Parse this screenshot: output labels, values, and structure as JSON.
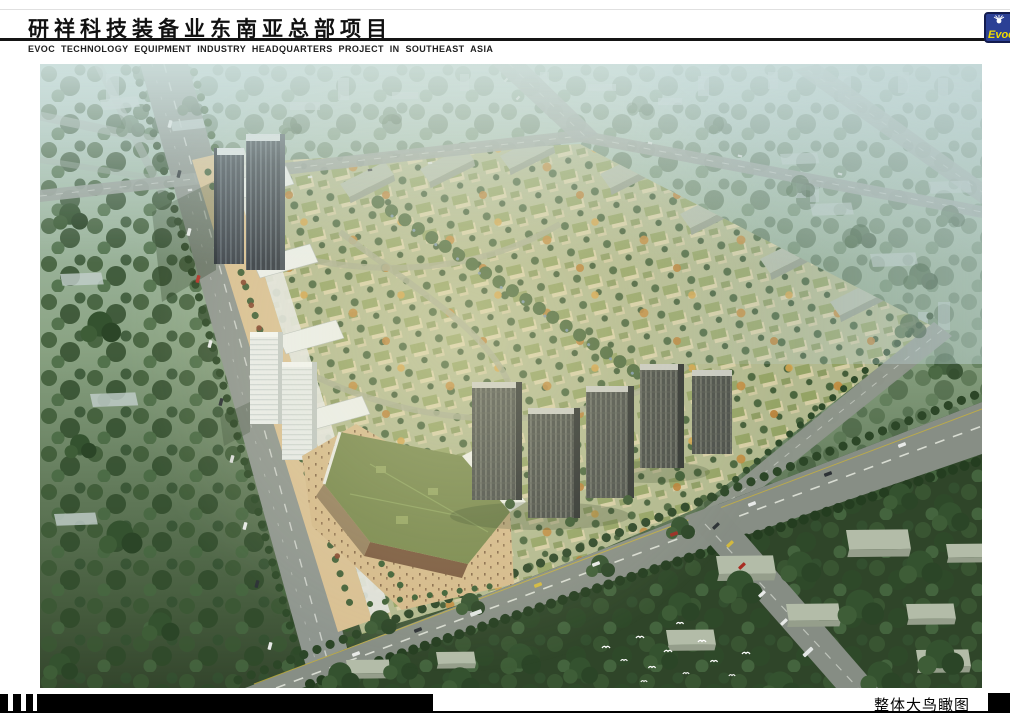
{
  "header": {
    "title_cn": "研祥科技装备业东南亚总部项目",
    "subtitle_en": "EVOC TECHNOLOGY EQUIPMENT INDUSTRY HEADQUARTERS PROJECT IN SOUTHEAST ASIA",
    "logo": {
      "text": "Evoc",
      "icon": "sunburst-icon",
      "bg_color": "#2b4095",
      "border_color": "#131c4f",
      "text_color": "#f2dc00"
    }
  },
  "artwork": {
    "type": "aerial-architectural-rendering",
    "palette": {
      "haze_top": "#b7cdc8",
      "foliage_dark": "#2e4929",
      "road_gray": "#8f968f",
      "site_green": "#b2b98f",
      "plaza_tan": "#d5ba8b",
      "big_roof_olive": "#79894e",
      "tower_dark": "#3a414a"
    }
  },
  "footer": {
    "caption": "整体大鸟瞰图"
  }
}
